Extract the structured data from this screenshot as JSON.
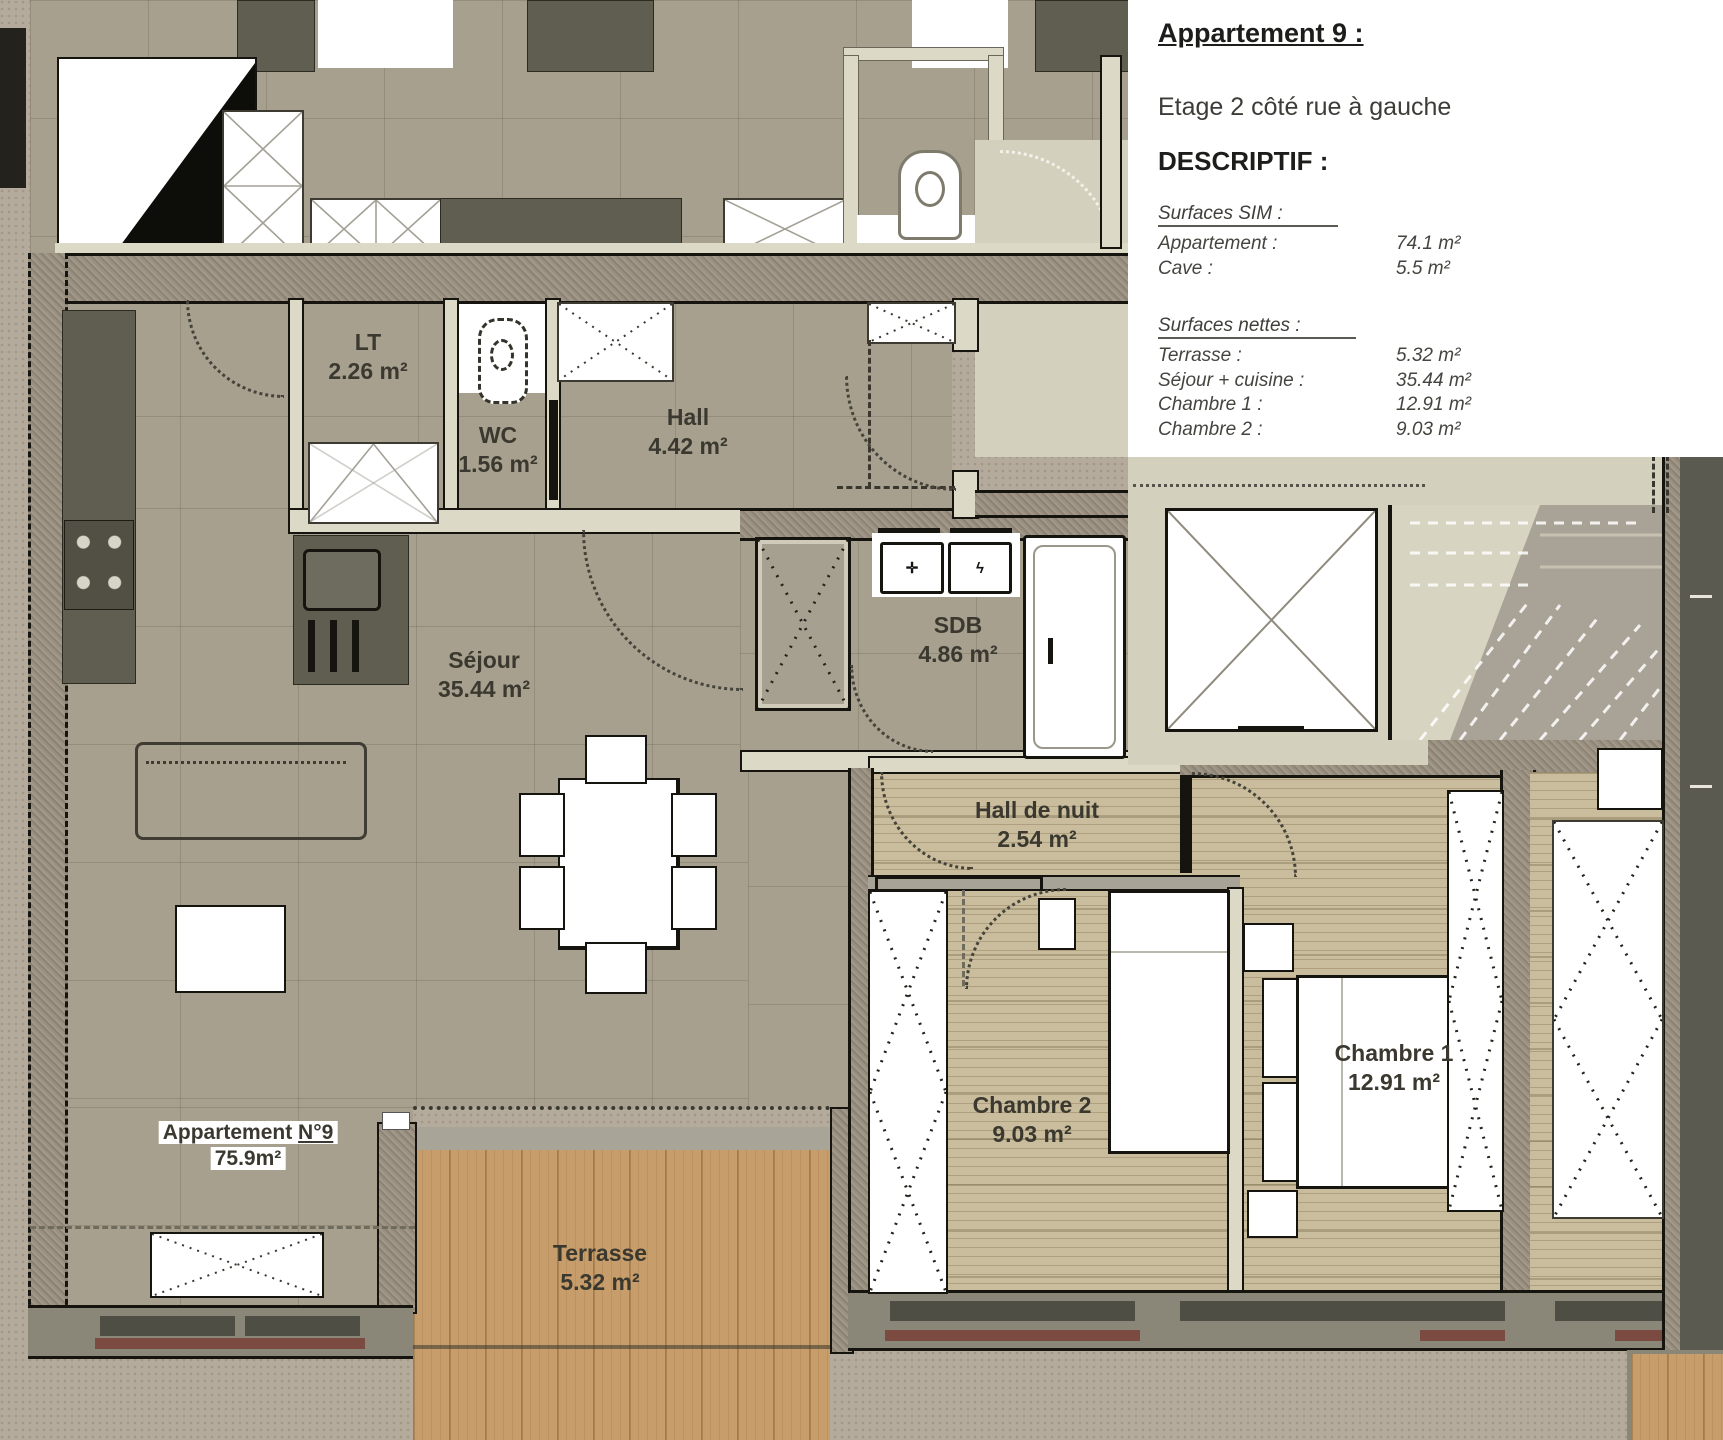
{
  "info_panel": {
    "title": "Appartement 9 :",
    "subtitle": "Etage 2 côté rue à gauche",
    "descriptif_heading": "DESCRIPTIF :",
    "surfaces_sim": {
      "heading": "Surfaces SIM :",
      "rows": [
        {
          "label": "Appartement :",
          "value": "74.1 m²"
        },
        {
          "label": "Cave :",
          "value": "5.5 m²"
        }
      ]
    },
    "surfaces_nettes": {
      "heading": "Surfaces nettes :",
      "rows": [
        {
          "label": "Terrasse :",
          "value": "5.32 m²"
        },
        {
          "label": "Séjour + cuisine :",
          "value": "35.44 m²"
        },
        {
          "label": "Chambre 1  :",
          "value": "12.91 m²"
        },
        {
          "label": "Chambre 2  :",
          "value": "9.03 m²"
        }
      ]
    }
  },
  "rooms": {
    "lt": {
      "name": "LT",
      "area": "2.26 m²"
    },
    "wc": {
      "name": "WC",
      "area": "1.56 m²"
    },
    "hall": {
      "name": "Hall",
      "area": "4.42 m²"
    },
    "sejour": {
      "name": "Séjour",
      "area": "35.44 m²"
    },
    "sdb": {
      "name": "SDB",
      "area": "4.86 m²"
    },
    "hall_de_nuit": {
      "name": "Hall de nuit",
      "area": "2.54 m²"
    },
    "chambre1": {
      "name": "Chambre 1",
      "area": "12.91 m²"
    },
    "chambre2": {
      "name": "Chambre 2",
      "area": "9.03 m²"
    },
    "terrasse": {
      "name": "Terrasse",
      "area": "5.32 m²"
    }
  },
  "apartment_tag": {
    "prefix": "Appartement ",
    "number": "N°9",
    "area": "75.9m²"
  },
  "colors": {
    "floor_tile": "#a7a08f",
    "bedroom_wood": "#c9bd9d",
    "terrace_wood": "#c79e6b",
    "wall_fill": "#99907f",
    "landing": "#d3d0bd",
    "window_sill": "#7b4b42",
    "dark_furniture": "#5f5e50",
    "panel_background": "#ffffff"
  }
}
